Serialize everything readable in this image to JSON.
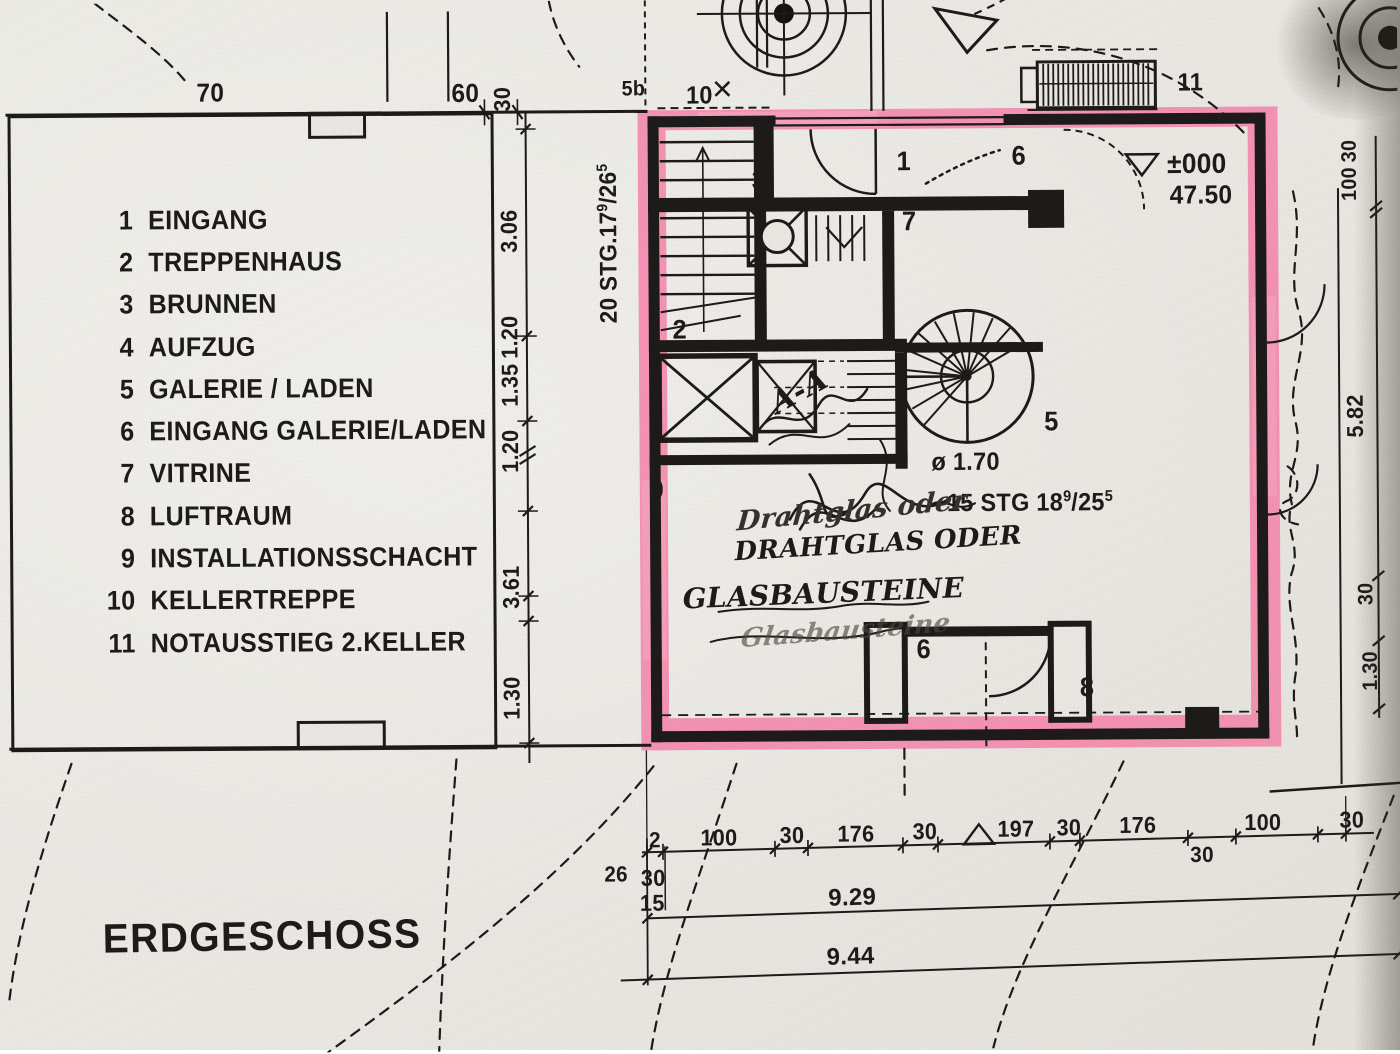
{
  "title": "ERDGESCHOSS",
  "legend": {
    "items": [
      {
        "num": "1",
        "label": "EINGANG"
      },
      {
        "num": "2",
        "label": "TREPPENHAUS"
      },
      {
        "num": "3",
        "label": "BRUNNEN"
      },
      {
        "num": "4",
        "label": "AUFZUG"
      },
      {
        "num": "5",
        "label": "GALERIE / LADEN"
      },
      {
        "num": "6",
        "label": "EINGANG GALERIE/LADEN"
      },
      {
        "num": "7",
        "label": "VITRINE"
      },
      {
        "num": "8",
        "label": "LUFTRAUM"
      },
      {
        "num": "9",
        "label": "INSTALLATIONSSCHACHT"
      },
      {
        "num": "10",
        "label": "KELLERTREPPE"
      },
      {
        "num": "11",
        "label": "NOTAUSSTIEG 2.KELLER"
      }
    ]
  },
  "room_labels": {
    "r1": "1",
    "r2": "2",
    "r3": "3",
    "r5": "5",
    "r6_top": "6",
    "r6_bottom": "6",
    "r7": "7",
    "r8": "8",
    "r9": "9",
    "r10": "10",
    "r11": "11"
  },
  "level_marker": {
    "line1": "±000",
    "line2": "47.50"
  },
  "stair_notes": {
    "left": {
      "pre": "20 STG.17",
      "sup1": "9",
      "mid": "/26",
      "sup2": "5"
    },
    "spiral": {
      "pre": "15 STG 18",
      "sup1": "9",
      "mid": "/25",
      "sup2": "5"
    },
    "spiral_diameter": "ø 1.70"
  },
  "handwritten": {
    "line1": "Drahtglas oder",
    "line2": "DRAHTGLAS ODER",
    "line3": "GLASBAUSTEINE",
    "line4": "Glasbausteine",
    "section_mark": "A-A"
  },
  "dims": {
    "top": {
      "d70": "70",
      "d60": "60",
      "d5b": "5b"
    },
    "left_chain_top": "30",
    "left_chain": [
      "3.06",
      "1.20",
      "1.35",
      "1.20",
      "3.61",
      "1.30"
    ],
    "right_chain": {
      "t30": "30",
      "t100": "100",
      "d582": "5.82",
      "b30": "30",
      "b130": "1.30"
    },
    "bottom_chain": [
      "2",
      "100",
      "30",
      "176",
      "30",
      "197",
      "30",
      "176",
      "100",
      "30"
    ],
    "bottom_chain_sub": "30",
    "bottom_left_stack": [
      "26",
      "30",
      "15"
    ],
    "totals": {
      "t929": "9.29",
      "t944": "9.44"
    }
  },
  "colors": {
    "highlight_pink": "#f583ab",
    "ink": "#1d1b19",
    "paper": "#e9e7e2"
  }
}
